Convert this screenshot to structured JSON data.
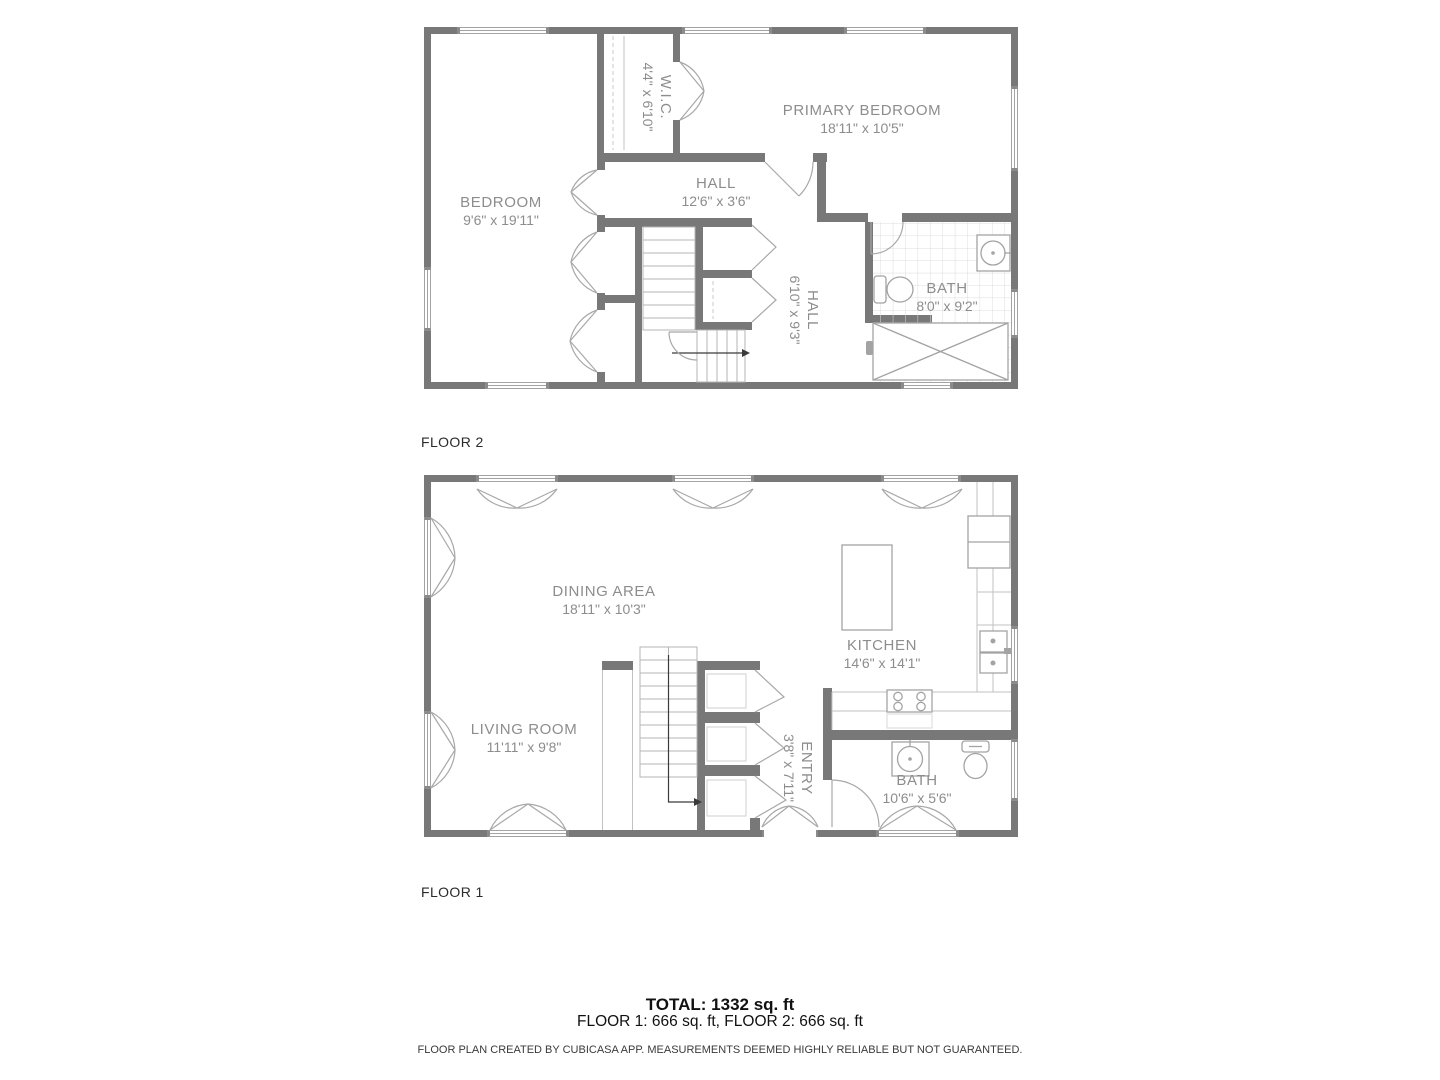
{
  "page": {
    "width": 1440,
    "height": 1080,
    "background": "#ffffff"
  },
  "floor_plans": [
    {
      "label": "FLOOR 2",
      "rooms": [
        {
          "id": "wic",
          "name": "W.I.C.",
          "dims": "4'4\" x 6'10\""
        },
        {
          "id": "primary-bedroom",
          "name": "PRIMARY BEDROOM",
          "dims": "18'11\" x 10'5\""
        },
        {
          "id": "bedroom",
          "name": "BEDROOM",
          "dims": "9'6\" x 19'11\""
        },
        {
          "id": "hall-upper",
          "name": "HALL",
          "dims": "12'6\" x 3'6\""
        },
        {
          "id": "hall-lower",
          "name": "HALL",
          "dims": "6'10\" x 9'3\""
        },
        {
          "id": "bath",
          "name": "BATH",
          "dims": "8'0\" x 9'2\""
        }
      ]
    },
    {
      "label": "FLOOR 1",
      "rooms": [
        {
          "id": "dining-area",
          "name": "DINING AREA",
          "dims": "18'11\" x 10'3\""
        },
        {
          "id": "kitchen",
          "name": "KITCHEN",
          "dims": "14'6\" x 14'1\""
        },
        {
          "id": "living-room",
          "name": "LIVING ROOM",
          "dims": "11'11\" x 9'8\""
        },
        {
          "id": "entry",
          "name": "ENTRY",
          "dims": "3'8\" x 7'11\""
        },
        {
          "id": "bath",
          "name": "BATH",
          "dims": "10'6\" x 5'6\""
        }
      ]
    }
  ],
  "summary": {
    "total": "TOTAL: 1332 sq. ft",
    "floors": "FLOOR 1: 666 sq. ft, FLOOR 2: 666 sq. ft",
    "disclaimer": "FLOOR PLAN CREATED BY CUBICASA APP. MEASUREMENTS DEEMED HIGHLY RELIABLE BUT NOT GUARANTEED."
  },
  "colors": {
    "wall": "#787878",
    "fixture_line": "#a3a3a3",
    "room_label": "#8d8d8d",
    "tile_grid": "#dcdcdc",
    "dark_text": "#222222"
  }
}
